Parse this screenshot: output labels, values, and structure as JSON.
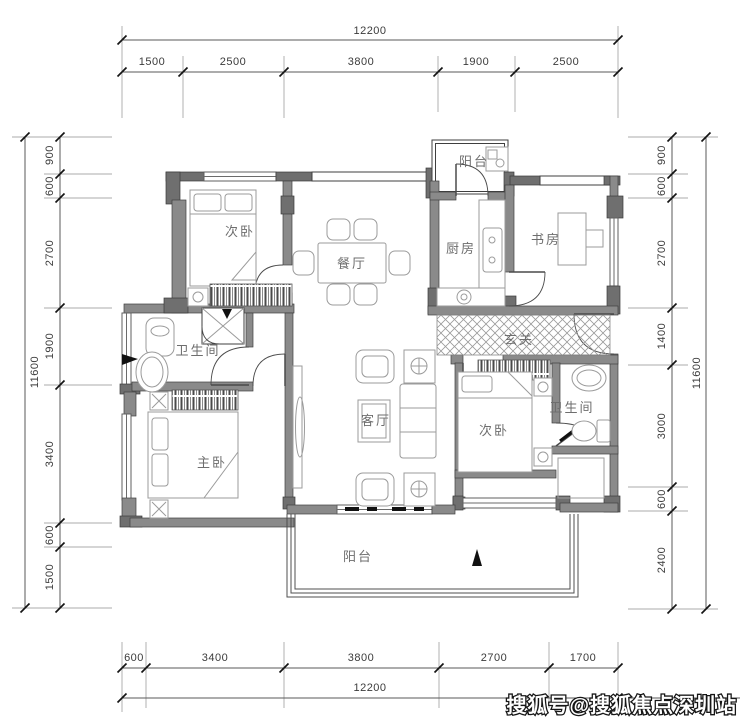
{
  "watermark": "搜狐号@搜狐焦点深圳站",
  "colors": {
    "wall_fill": "#8a8a8a",
    "wall_dark": "#6f6f6f",
    "line": "#3f3f3f",
    "furniture_line": "#9b9b9b",
    "room_text": "#6e6e6e",
    "dim_text": "#3b3b3b",
    "background": "#ffffff"
  },
  "rooms": {
    "balcony_top": "阳台",
    "bedroom_top_left": "次卧",
    "dining": "餐厅",
    "kitchen": "厨房",
    "study": "书房",
    "bathroom_left": "卫生间",
    "entry": "玄关",
    "master_bedroom": "主卧",
    "living": "客厅",
    "bedroom_right": "次卧",
    "bathroom_right": "卫生间",
    "balcony_bottom": "阳台"
  },
  "dimensions": {
    "top": {
      "total": "12200",
      "segments": [
        "1500",
        "2500",
        "3800",
        "1900",
        "2500"
      ]
    },
    "bottom": {
      "total": "12200",
      "segments": [
        "600",
        "3400",
        "3800",
        "2700",
        "1700"
      ]
    },
    "left": {
      "total": "11600",
      "segments": [
        "900",
        "600",
        "2700",
        "1900",
        "3400",
        "600",
        "1500"
      ]
    },
    "right": {
      "total": "11600",
      "segments": [
        "900",
        "600",
        "2700",
        "1400",
        "3000",
        "600",
        "2400"
      ]
    }
  }
}
